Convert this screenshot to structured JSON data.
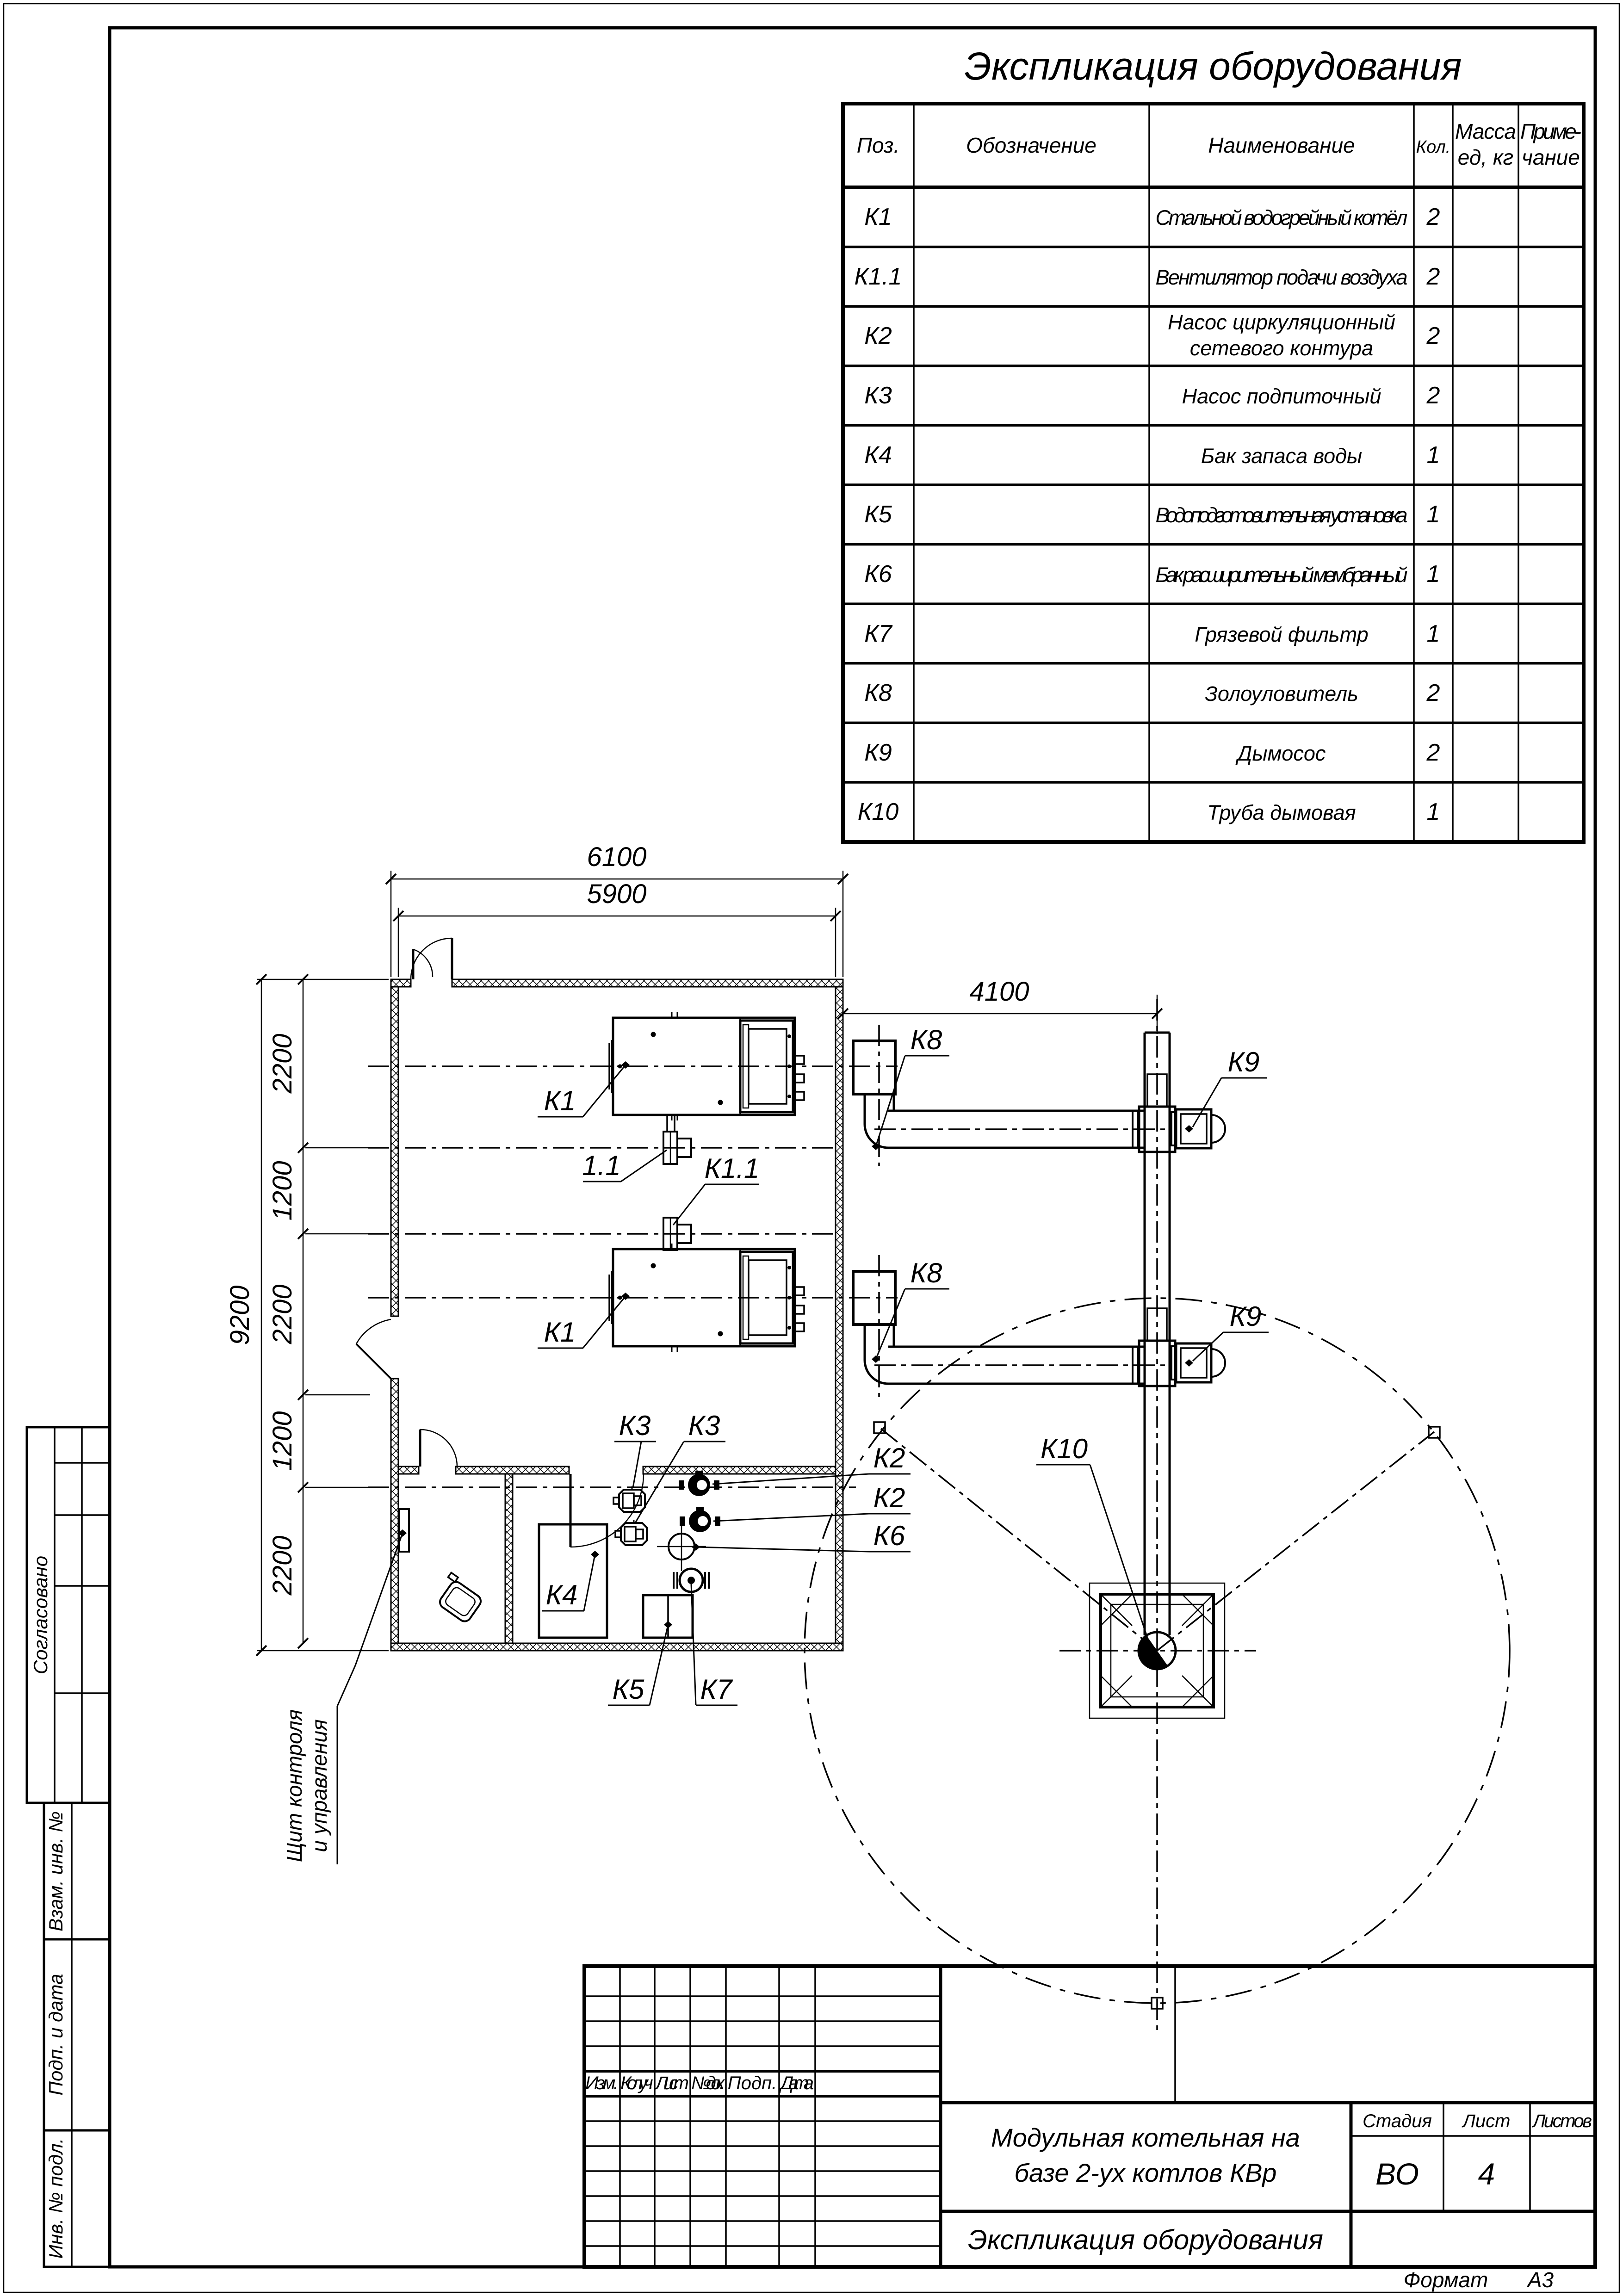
{
  "table": {
    "title": "Экспликация оборудования",
    "headers": {
      "pos": "Поз.",
      "designation": "Обозначение",
      "name": "Наименование",
      "qty": "Кол.",
      "mass1": "Масса",
      "mass2": "ед, кг",
      "note1": "Приме-",
      "note2": "чание"
    },
    "rows": [
      {
        "pos": "К1",
        "name": "Стальной водогрейный котёл",
        "qty": "2"
      },
      {
        "pos": "К1.1",
        "name": "Вентилятор подачи воздуха",
        "qty": "2"
      },
      {
        "pos": "К2",
        "name": "Насос циркуляционный",
        "name2": "сетевого контура",
        "qty": "2"
      },
      {
        "pos": "К3",
        "name": "Насос подпиточный",
        "qty": "2"
      },
      {
        "pos": "К4",
        "name": "Бак запаса воды",
        "qty": "1"
      },
      {
        "pos": "К5",
        "name": "Водоподготовительная установка",
        "qty": "1"
      },
      {
        "pos": "К6",
        "name": "Бак расширительный мембранный",
        "qty": "1"
      },
      {
        "pos": "К7",
        "name": "Грязевой фильтр",
        "qty": "1"
      },
      {
        "pos": "К8",
        "name": "Золоуловитель",
        "qty": "2"
      },
      {
        "pos": "К9",
        "name": "Дымосос",
        "qty": "2"
      },
      {
        "pos": "К10",
        "name": "Труба дымовая",
        "qty": "1"
      }
    ]
  },
  "title_block": {
    "project_line1": "Модульная котельная на",
    "project_line2": "базе 2-ух котлов КВр",
    "doc_title": "Экспликация оборудования",
    "stage_label": "Стадия",
    "stage_value": "ВО",
    "sheet_label": "Лист",
    "sheet_value": "4",
    "sheets_label": "Листов",
    "rev": {
      "izm": "Изм.",
      "koluch": "Кол.уч.",
      "list": "Лист",
      "ndok": "№док.",
      "podp": "Подп.",
      "data": "Дата"
    },
    "format_label": "Формат",
    "format_value": "А3"
  },
  "side_stamps": {
    "approved": "Согласовано",
    "vzam": "Взам. инв. №",
    "podp_data": "Подп. и дата",
    "inv_podl": "Инв. № подл."
  },
  "plan": {
    "labels": {
      "k1": "К1",
      "f11": "1.1",
      "k11": "К1.1",
      "k2": "К2",
      "k3": "К3",
      "k4": "К4",
      "k5": "К5",
      "k6": "К6",
      "k7": "К7",
      "k8": "К8",
      "k9": "К9",
      "k10": "К10",
      "panel_line1": "Щит контроля",
      "panel_line2": "и управления"
    },
    "dims": {
      "width_outer": "6100",
      "width_inner": "5900",
      "flue": "4100",
      "height_outer": "9200",
      "seg1": "2200",
      "seg2": "1200",
      "seg3": "2200",
      "seg4": "1200",
      "seg5": "2200"
    }
  }
}
